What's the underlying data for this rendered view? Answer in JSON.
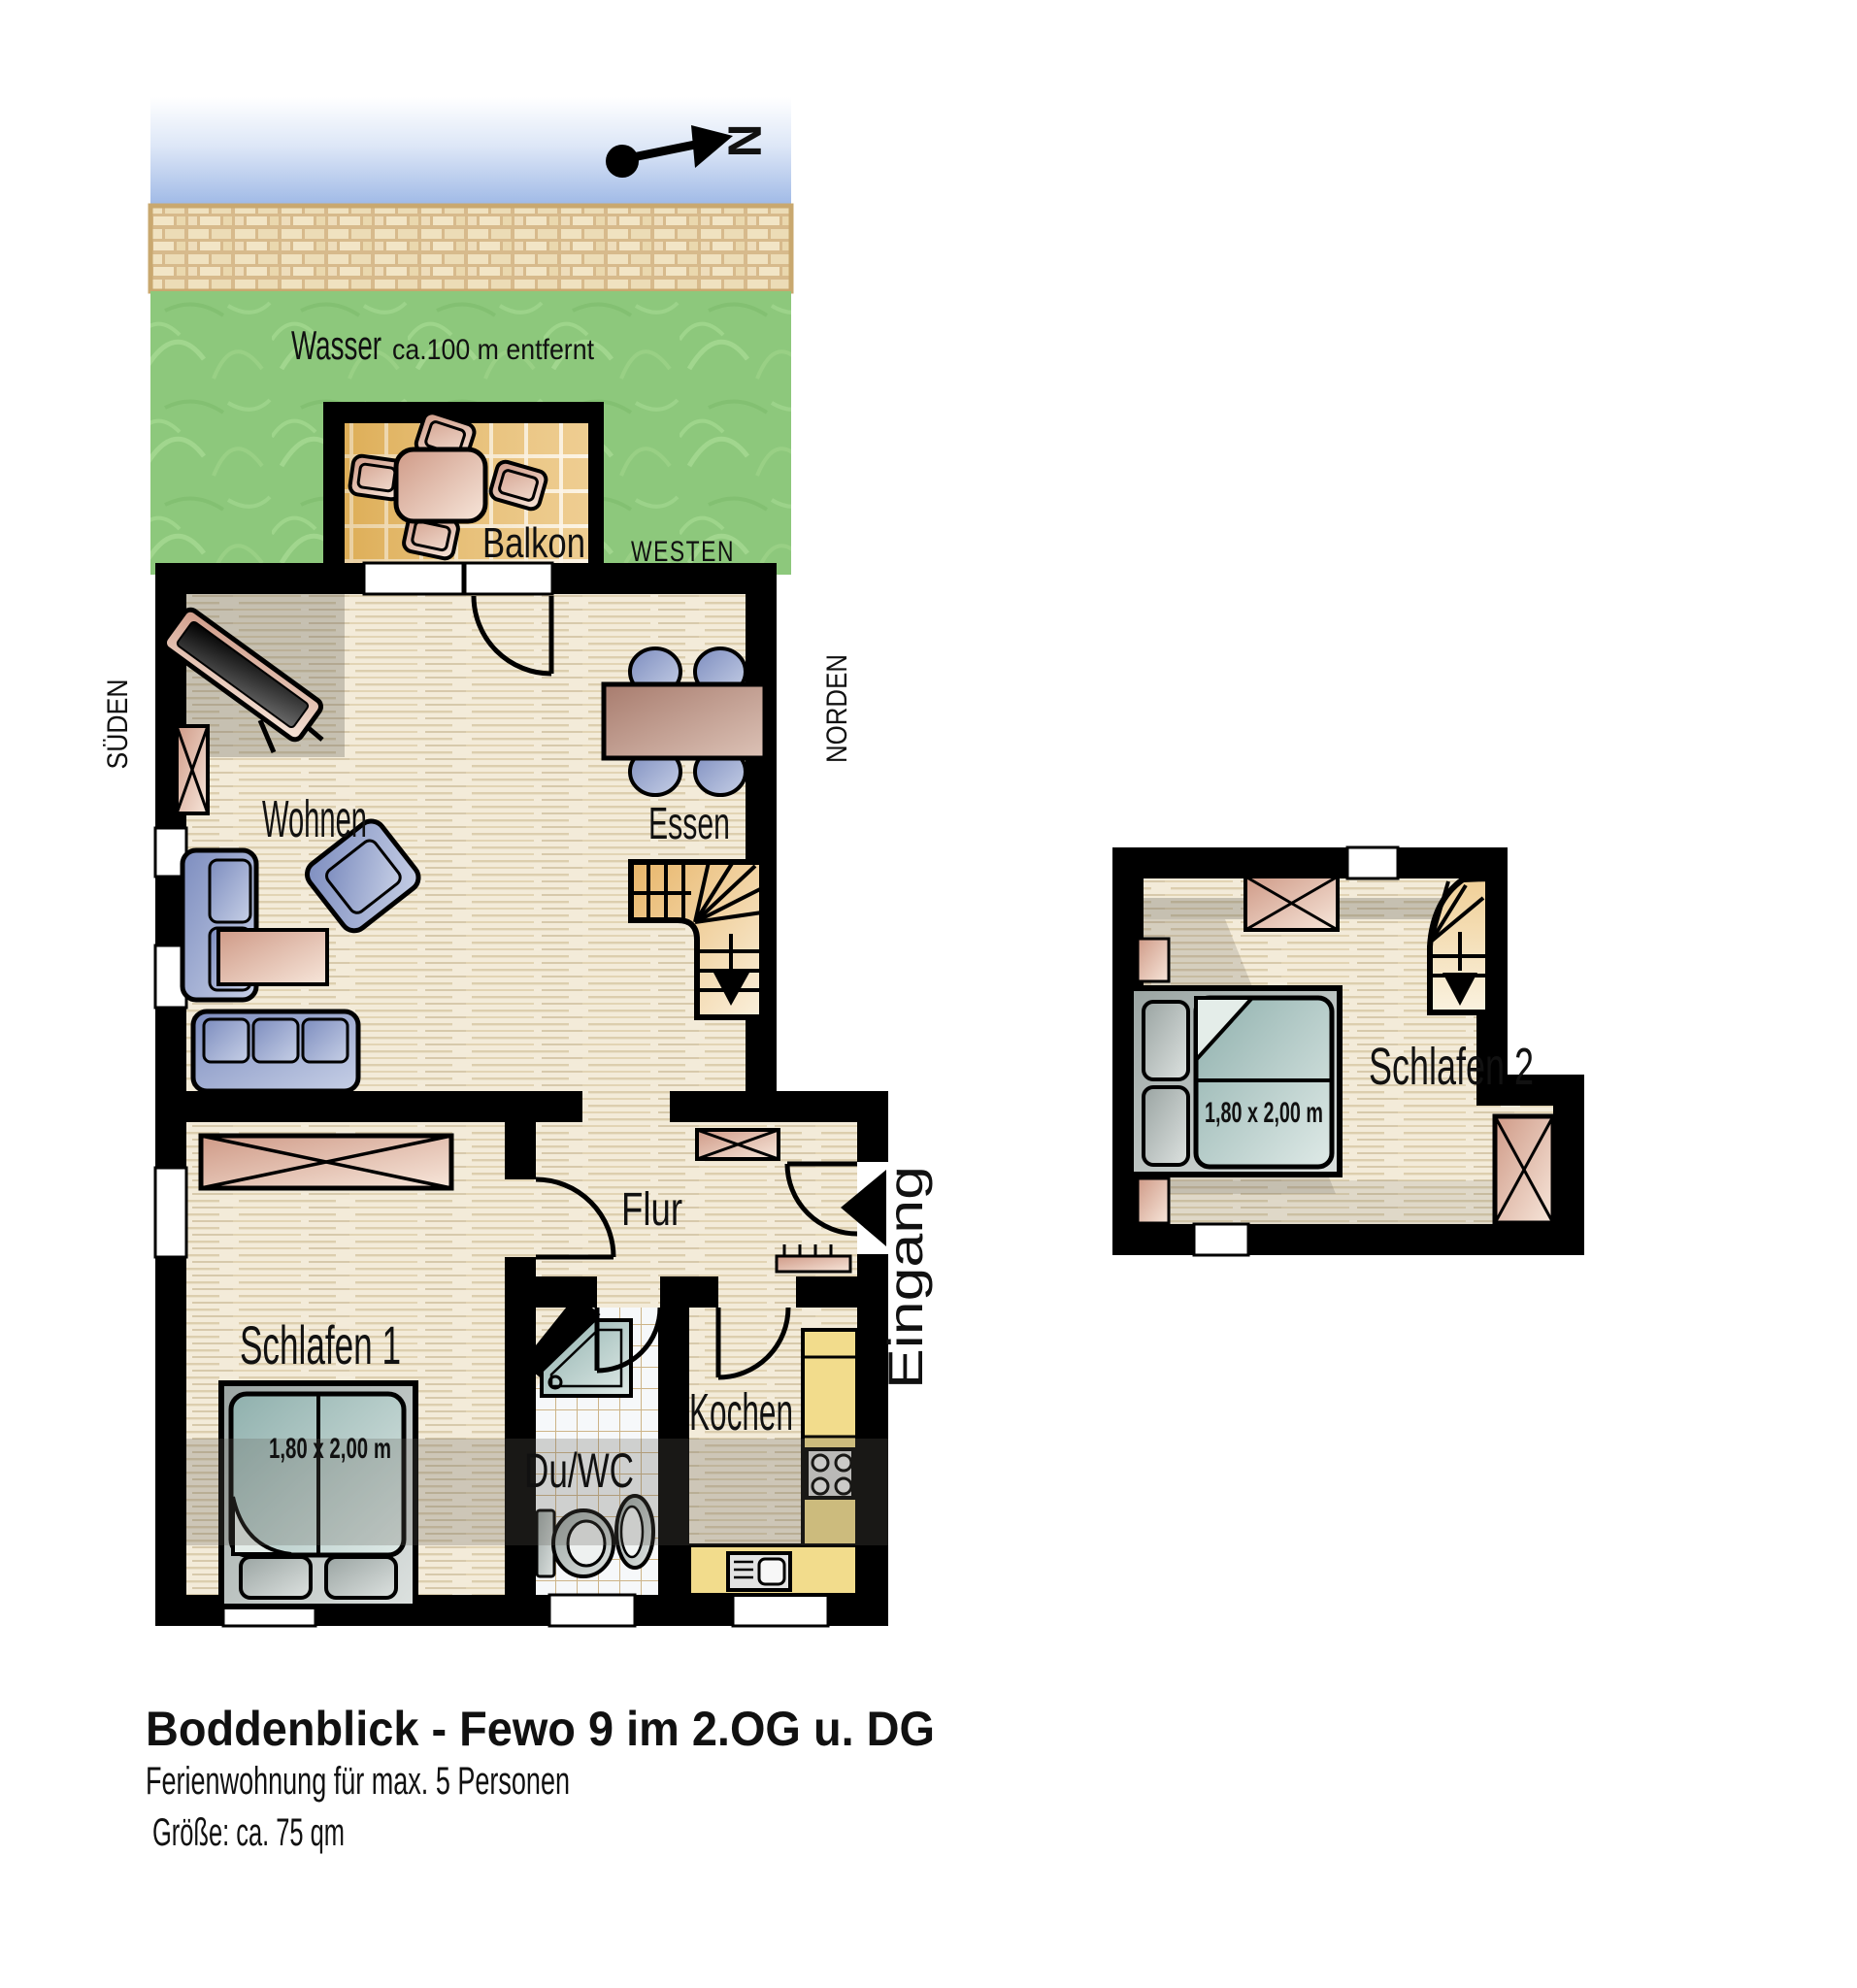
{
  "plan": {
    "compass_n": "N",
    "water_label": "Wasser",
    "water_distance": "ca.100 m entfernt",
    "dir_west": "WESTEN",
    "dir_south": "SÜDEN",
    "dir_north": "NORDEN",
    "rooms": {
      "balcony": "Balkon",
      "living": "Wohnen",
      "dining": "Essen",
      "hall": "Flur",
      "bedroom1": "Schlafen 1",
      "bath": "Du/WC",
      "kitchen": "Kochen",
      "bedroom2": "Schlafen 2"
    },
    "entrance": "Eingang",
    "bed1_size": "1,80 x 2,00 m",
    "bed2_size": "1,80 x 2,00 m"
  },
  "caption": {
    "title": "Boddenblick - Fewo 9 im 2.OG u. DG",
    "line2": "Ferienwohnung für max. 5 Personen",
    "line3": "Größe: ca. 75 qm"
  },
  "colors": {
    "wall": "#000000",
    "floor": "#f3ebd9",
    "water": "#9fb9e6",
    "sand": "#ead9b2",
    "grass": "#8dc87c",
    "furniture_blue": "#8f9ec9",
    "furniture_pink": "#dba895",
    "bed_teal": "#9ab5b2",
    "kitchen_yellow": "#f2dc8c",
    "balcony_tile": "#e9bd6d"
  }
}
